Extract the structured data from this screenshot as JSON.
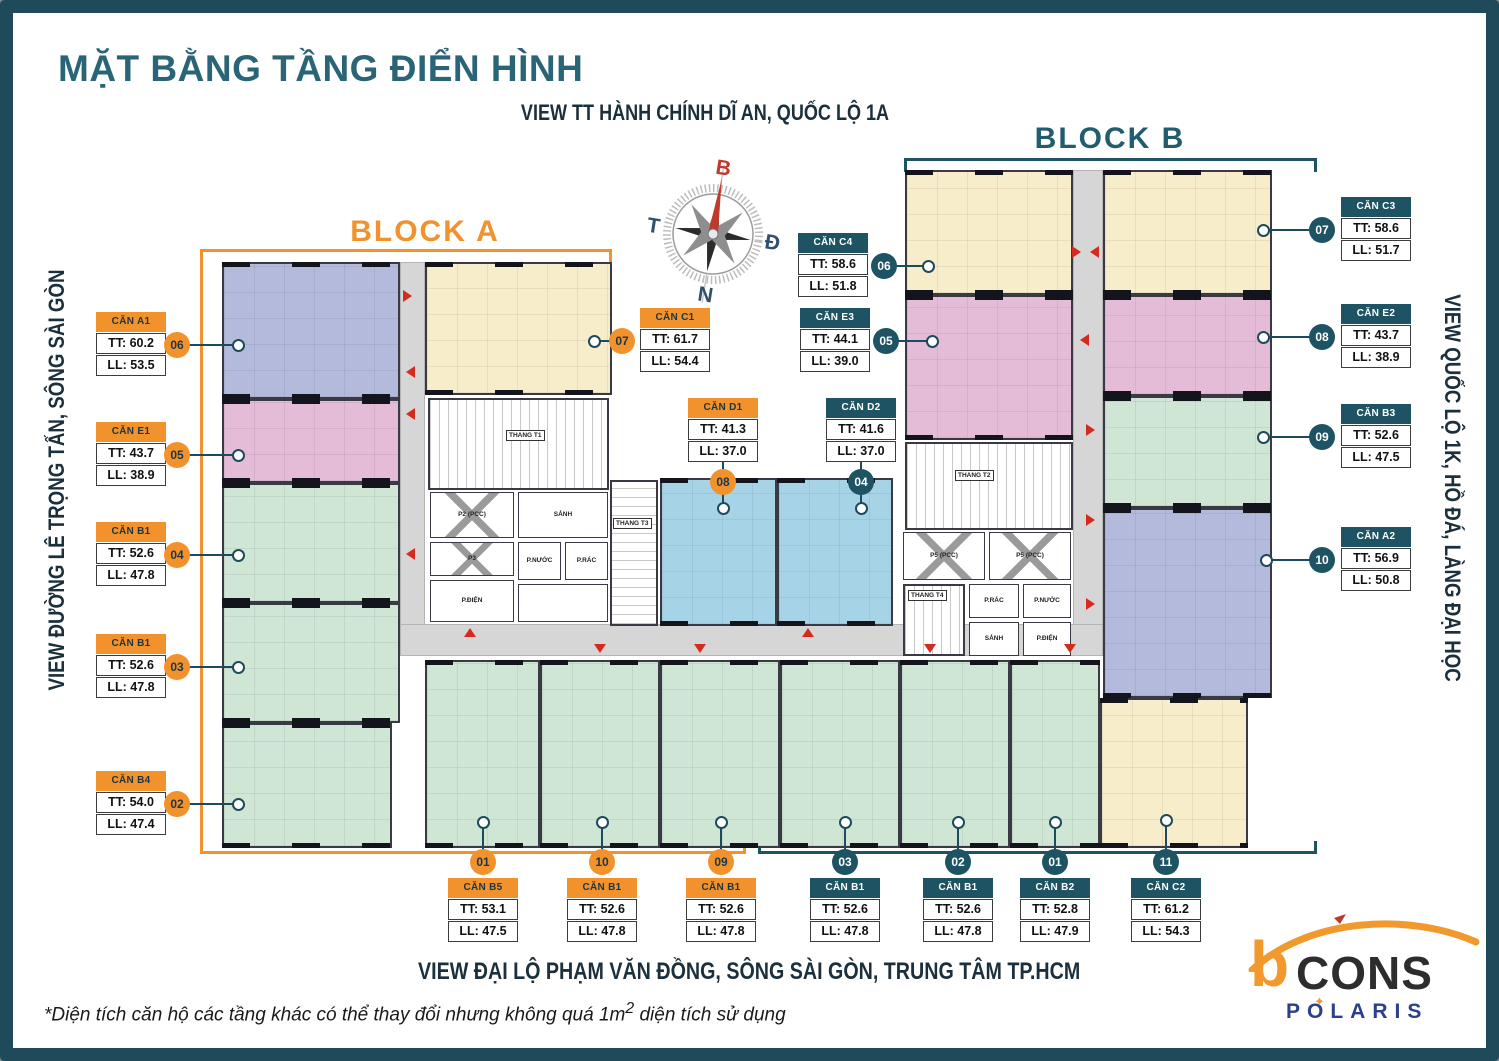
{
  "title": "MẶT BẰNG TẦNG ĐIỂN HÌNH",
  "views": {
    "top": "VIEW TT HÀNH CHÍNH DĨ AN, QUỐC LỘ 1A",
    "left": "VIEW ĐƯỜNG LÊ TRỌNG TẤN, SÔNG SÀI GÒN",
    "right": "VIEW QUỐC LỘ 1K, HỒ ĐÁ, LÀNG ĐẠI HỌC",
    "bottom": "VIEW ĐẠI LỘ PHẠM VĂN ĐỒNG, SÔNG SÀI GÒN, TRUNG TÂM TP.HCM"
  },
  "footnote": {
    "pre": "*Diện tích căn hộ các tầng khác có thể thay đổi nhưng không quá 1m",
    "sup": "2",
    "post": " diện tích sử dụng"
  },
  "blocks": {
    "a": "BLOCK A",
    "b": "BLOCK B"
  },
  "compass": {
    "north": "B",
    "east": "Đ",
    "west": "T",
    "south": "N"
  },
  "logo": {
    "mark": "b",
    "brand": "CONS",
    "sub_brand": "POLARIS",
    "star": "✦"
  },
  "colors": {
    "frame": "#1E4A5A",
    "title": "#2A6577",
    "navy_text": "#1B2F3C",
    "block_a_accent": "#F2922D",
    "block_b_accent": "#1D5362",
    "unit_yellow": "#F8EDCA",
    "unit_purple": "#B4BADB",
    "unit_pink": "#E4BCD7",
    "unit_green": "#CFE6D4",
    "unit_blue": "#A6D3E6",
    "corridor": "#D6D6D6",
    "arrow_red": "#D42B1E"
  },
  "rooms": {
    "thang_t1": "THANG T1",
    "thang_t2": "THANG T2",
    "thang_t3": "THANG T3",
    "thang_t4": "THANG T4",
    "lift_a": "P2 (PCC)",
    "p3": "P3",
    "lift_b1": "P5 (PCC)",
    "lift_b2": "P5 (PCC)",
    "lobby_a": "SẢNH",
    "lobby_b": "SẢNH",
    "elec_a": "P.ĐIỆN",
    "elec_b": "P.ĐIỆN",
    "water_a": "P.NƯỚC",
    "water_b": "P.NƯỚC",
    "trash_a": "P.RÁC",
    "trash_b": "P.RÁC"
  },
  "units": [
    {
      "name": "CĂN A1",
      "tt": "TT: 60.2",
      "ll": "LL: 53.5",
      "num": "06",
      "block": "A",
      "label": {
        "x": 96,
        "y": 312
      },
      "circle": {
        "x": 177,
        "y": 345
      },
      "dot": {
        "x": 238,
        "y": 345
      },
      "orient": "right"
    },
    {
      "name": "CĂN E1",
      "tt": "TT: 43.7",
      "ll": "LL: 38.9",
      "num": "05",
      "block": "A",
      "label": {
        "x": 96,
        "y": 422
      },
      "circle": {
        "x": 177,
        "y": 455
      },
      "dot": {
        "x": 238,
        "y": 455
      },
      "orient": "right"
    },
    {
      "name": "CĂN B1",
      "tt": "TT: 52.6",
      "ll": "LL: 47.8",
      "num": "04",
      "block": "A",
      "label": {
        "x": 96,
        "y": 522
      },
      "circle": {
        "x": 177,
        "y": 555
      },
      "dot": {
        "x": 238,
        "y": 555
      },
      "orient": "right"
    },
    {
      "name": "CĂN B1",
      "tt": "TT: 52.6",
      "ll": "LL: 47.8",
      "num": "03",
      "block": "A",
      "label": {
        "x": 96,
        "y": 634
      },
      "circle": {
        "x": 177,
        "y": 667
      },
      "dot": {
        "x": 238,
        "y": 667
      },
      "orient": "right"
    },
    {
      "name": "CĂN B4",
      "tt": "TT: 54.0",
      "ll": "LL: 47.4",
      "num": "02",
      "block": "A",
      "label": {
        "x": 96,
        "y": 771
      },
      "circle": {
        "x": 177,
        "y": 804
      },
      "dot": {
        "x": 238,
        "y": 804
      },
      "orient": "right"
    },
    {
      "name": "CĂN C1",
      "tt": "TT: 61.7",
      "ll": "LL: 54.4",
      "num": "07",
      "block": "A",
      "label": {
        "x": 640,
        "y": 308
      },
      "circle": {
        "x": 622,
        "y": 341
      },
      "dot": {
        "x": 594,
        "y": 341
      },
      "orient": "left"
    },
    {
      "name": "CĂN D1",
      "tt": "TT: 41.3",
      "ll": "LL: 37.0",
      "num": "08",
      "block": "A",
      "label": {
        "x": 688,
        "y": 398
      },
      "circle": {
        "x": 723,
        "y": 482
      },
      "dot": {
        "x": 723,
        "y": 508
      },
      "orient": "down"
    },
    {
      "name": "CĂN D2",
      "tt": "TT: 41.6",
      "ll": "LL: 37.0",
      "num": "04",
      "block": "B",
      "label": {
        "x": 826,
        "y": 398
      },
      "circle": {
        "x": 861,
        "y": 482
      },
      "dot": {
        "x": 861,
        "y": 508
      },
      "orient": "down"
    },
    {
      "name": "CĂN C4",
      "tt": "TT: 58.6",
      "ll": "LL: 51.8",
      "num": "06",
      "block": "B",
      "label": {
        "x": 798,
        "y": 233
      },
      "circle": {
        "x": 884,
        "y": 266
      },
      "dot": {
        "x": 928,
        "y": 266
      },
      "orient": "right"
    },
    {
      "name": "CĂN E3",
      "tt": "TT: 44.1",
      "ll": "LL: 39.0",
      "num": "05",
      "block": "B",
      "label": {
        "x": 800,
        "y": 308
      },
      "circle": {
        "x": 886,
        "y": 341
      },
      "dot": {
        "x": 932,
        "y": 341
      },
      "orient": "right"
    },
    {
      "name": "CĂN C3",
      "tt": "TT: 58.6",
      "ll": "LL: 51.7",
      "num": "07",
      "block": "B",
      "label": {
        "x": 1341,
        "y": 197
      },
      "circle": {
        "x": 1322,
        "y": 230
      },
      "dot": {
        "x": 1263,
        "y": 230
      },
      "orient": "left"
    },
    {
      "name": "CĂN E2",
      "tt": "TT: 43.7",
      "ll": "LL: 38.9",
      "num": "08",
      "block": "B",
      "label": {
        "x": 1341,
        "y": 304
      },
      "circle": {
        "x": 1322,
        "y": 337
      },
      "dot": {
        "x": 1263,
        "y": 337
      },
      "orient": "left"
    },
    {
      "name": "CĂN B3",
      "tt": "TT: 52.6",
      "ll": "LL: 47.5",
      "num": "09",
      "block": "B",
      "label": {
        "x": 1341,
        "y": 404
      },
      "circle": {
        "x": 1322,
        "y": 437
      },
      "dot": {
        "x": 1263,
        "y": 437
      },
      "orient": "left"
    },
    {
      "name": "CĂN A2",
      "tt": "TT: 56.9",
      "ll": "LL: 50.8",
      "num": "10",
      "block": "B",
      "label": {
        "x": 1341,
        "y": 527
      },
      "circle": {
        "x": 1322,
        "y": 560
      },
      "dot": {
        "x": 1266,
        "y": 560
      },
      "orient": "left"
    },
    {
      "name": "CĂN B5",
      "tt": "TT: 53.1",
      "ll": "LL: 47.5",
      "num": "01",
      "block": "A",
      "label": {
        "x": 448,
        "y": 878
      },
      "circle": {
        "x": 483,
        "y": 862
      },
      "dot": {
        "x": 483,
        "y": 822
      },
      "orient": "up"
    },
    {
      "name": "CĂN B1",
      "tt": "TT: 52.6",
      "ll": "LL: 47.8",
      "num": "10",
      "block": "A",
      "label": {
        "x": 567,
        "y": 878
      },
      "circle": {
        "x": 602,
        "y": 862
      },
      "dot": {
        "x": 602,
        "y": 822
      },
      "orient": "up"
    },
    {
      "name": "CĂN B1",
      "tt": "TT: 52.6",
      "ll": "LL: 47.8",
      "num": "09",
      "block": "A",
      "label": {
        "x": 686,
        "y": 878
      },
      "circle": {
        "x": 721,
        "y": 862
      },
      "dot": {
        "x": 721,
        "y": 822
      },
      "orient": "up"
    },
    {
      "name": "CĂN B1",
      "tt": "TT: 52.6",
      "ll": "LL: 47.8",
      "num": "03",
      "block": "B",
      "label": {
        "x": 810,
        "y": 878
      },
      "circle": {
        "x": 845,
        "y": 862
      },
      "dot": {
        "x": 845,
        "y": 822
      },
      "orient": "up"
    },
    {
      "name": "CĂN B1",
      "tt": "TT: 52.6",
      "ll": "LL: 47.8",
      "num": "02",
      "block": "B",
      "label": {
        "x": 923,
        "y": 878
      },
      "circle": {
        "x": 958,
        "y": 862
      },
      "dot": {
        "x": 958,
        "y": 822
      },
      "orient": "up"
    },
    {
      "name": "CĂN B2",
      "tt": "TT: 52.8",
      "ll": "LL: 47.9",
      "num": "01",
      "block": "B",
      "label": {
        "x": 1020,
        "y": 878
      },
      "circle": {
        "x": 1055,
        "y": 862
      },
      "dot": {
        "x": 1055,
        "y": 822
      },
      "orient": "up"
    },
    {
      "name": "CĂN C2",
      "tt": "TT: 61.2",
      "ll": "LL: 54.3",
      "num": "11",
      "block": "B",
      "label": {
        "x": 1131,
        "y": 878
      },
      "circle": {
        "x": 1166,
        "y": 862
      },
      "dot": {
        "x": 1166,
        "y": 820
      },
      "orient": "up"
    }
  ]
}
